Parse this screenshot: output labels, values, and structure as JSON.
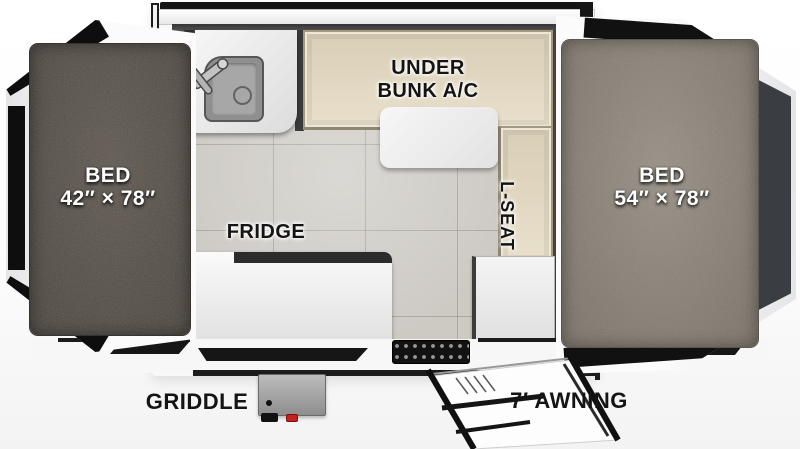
{
  "plan": {
    "type": "rv-popup-camper-floorplan",
    "beds": {
      "left": {
        "name": "BED",
        "size": "42″ × 78″"
      },
      "right": {
        "name": "BED",
        "size": "54″ × 78″"
      }
    },
    "labels": {
      "under_bunk_line1": "UNDER",
      "under_bunk_line2": "BUNK A/C",
      "l_seat": "L-SEAT",
      "fridge": "FRIDGE",
      "griddle": "GRIDDLE",
      "awning": "7′ AWNING"
    },
    "colors": {
      "mattress_left": "#57514a",
      "mattress_right": "#8f877d",
      "bench_beige": "#e4dac6",
      "floor_tile": "#cdcac4",
      "counter_white": "#f2f2f2",
      "trim_black": "#141414",
      "griddle_knob_red": "#c4201d"
    }
  }
}
